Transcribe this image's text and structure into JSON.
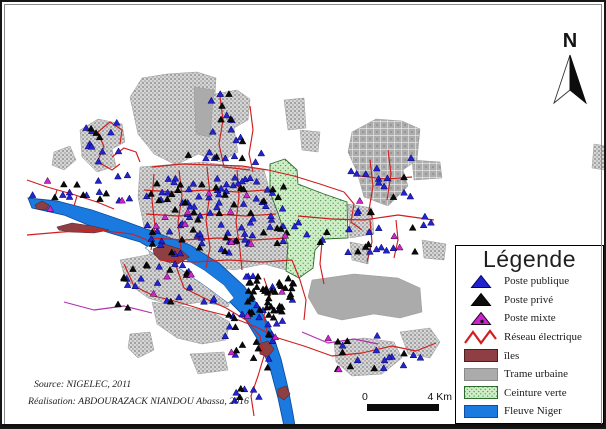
{
  "north": {
    "label": "N"
  },
  "legend": {
    "title": "Légende",
    "items": [
      {
        "label": "Poste publique",
        "swatch": "triangle",
        "color": "#2222cc",
        "edge": "#00006b"
      },
      {
        "label": "Poste privé",
        "swatch": "triangle",
        "color": "#0c0c0c",
        "edge": "#000000"
      },
      {
        "label": "Poste mixte",
        "swatch": "triangle-dot",
        "color": "#cc22cc",
        "edge": "#1a001a"
      },
      {
        "label": "Réseau électrique",
        "swatch": "zigzag",
        "color": "#cf1f1f",
        "edge": "#cf1f1f"
      },
      {
        "label": "îles",
        "swatch": "rect",
        "color": "#8e3f44",
        "edge": "#4a2021"
      },
      {
        "label": "Trame urbaine",
        "swatch": "rect",
        "color": "#ababab",
        "edge": "#8a8a8a"
      },
      {
        "label": "Ceinture verte",
        "swatch": "rect-dots",
        "color": "#cfeec8",
        "edge": "#2e6b2e"
      },
      {
        "label": "Fleuve Niger",
        "swatch": "rect",
        "color": "#1b7ae0",
        "edge": "#0f4f9e"
      }
    ]
  },
  "scale_bar": {
    "left_label": "0",
    "right_label": "4 Km"
  },
  "credits": {
    "line1": "Source: NIGELEC, 2011",
    "line2": "Réalisation: ABDOURAZACK NIANDOU Abassa, 2016"
  },
  "colors": {
    "river_fill": "#1b7ae0",
    "river_edge": "#0f4f9e",
    "island_fill": "#8e3f44",
    "island_edge": "#59272b",
    "urban_solid": "#ababab",
    "urban_edge": "#9a9a9a",
    "green_edge": "#2e6b2e",
    "network_red": "#cf1f1f",
    "network_magenta": "#b12fb1",
    "post_publique": "#2424cf",
    "post_publique_edge": "#000066",
    "post_prive": "#0a0a0a",
    "post_mixte": "#cf24cf",
    "post_mixte_edge": "#330033"
  },
  "geometry": {
    "urban_patches": [
      {
        "tex": "fine",
        "pts": "128,95 140,76 165,72 195,70 214,76 213,92 235,88 248,97 246,118 232,126 236,150 218,160 196,152 174,163 152,152 136,132"
      },
      {
        "tex": "solid",
        "pts": "192,85 212,88 208,135 194,132"
      },
      {
        "tex": "fine",
        "pts": "78,128 96,117 120,122 123,140 110,147 114,164 95,170 80,155"
      },
      {
        "tex": "fine",
        "pts": "52,150 68,144 74,158 62,168 50,163"
      },
      {
        "tex": "grid",
        "pts": "350,130 374,117 400,119 418,127 415,158 401,168 406,184 386,204 362,195 355,170 346,150"
      },
      {
        "tex": "grid",
        "pts": "410,158 438,160 440,176 412,178"
      },
      {
        "tex": "fine",
        "pts": "138,165 200,160 262,168 268,190 277,214 286,243 284,268 262,262 232,268 198,262 168,268 148,255 142,225 136,195"
      },
      {
        "tex": "fine",
        "pts": "346,202 370,206 372,232 348,236"
      },
      {
        "tex": "fine",
        "pts": "348,240 368,244 366,262 350,258"
      },
      {
        "tex": "solid",
        "pts": "310,278 352,272 396,276 418,286 420,310 398,316 372,312 340,318 316,312 306,295"
      },
      {
        "tex": "fine",
        "pts": "118,258 150,252 185,262 215,276 232,290 226,305 200,300 172,304 146,296 124,280"
      },
      {
        "tex": "fine",
        "pts": "150,300 180,304 210,310 228,320 224,338 200,342 175,336 155,322"
      },
      {
        "tex": "fine",
        "pts": "128,332 148,330 152,348 136,356 126,346"
      },
      {
        "tex": "fine",
        "pts": "188,352 222,350 226,368 196,372"
      },
      {
        "tex": "fine",
        "pts": "332,340 362,336 392,340 400,356 380,372 350,374 334,360"
      },
      {
        "tex": "fine",
        "pts": "398,330 428,326 438,340 428,356 406,352"
      },
      {
        "tex": "fine",
        "pts": "420,238 444,242 442,258 422,256"
      },
      {
        "tex": "fine",
        "pts": "282,98 302,96 304,126 286,128"
      },
      {
        "tex": "fine",
        "pts": "298,128 318,130 316,150 300,148"
      },
      {
        "tex": "fine",
        "pts": "592,142 604,144 603,168 590,166"
      }
    ],
    "green_belt": "268,162 283,157 295,168 296,182 322,192 345,200 346,236 323,237 313,248 311,266 297,276 284,269 286,243 277,214 268,190",
    "river": "26,196 55,199 90,208 125,220 155,231 188,243 218,262 242,284 258,306 270,330 279,357 286,386 291,412 293,424 282,424 276,396 268,366 256,338 240,312 220,292 196,274 168,258 138,240 98,228 62,213 30,206",
    "river_island": "150,242 178,254 202,268 222,283 232,296 226,301 206,286 180,268 152,252 143,246",
    "islands": [
      "33,203 40,199 47,203 44,208 35,207",
      "55,225 70,221 90,224 107,228 92,231 68,230 57,228",
      "151,247 162,242 178,247 187,255 176,262 158,258 152,252",
      "257,342 266,339 272,347 266,355 258,352",
      "276,387 284,384 288,392 282,398 276,394"
    ],
    "network": [
      {
        "c": "r",
        "pts": "25,233 60,230 95,228 130,232 150,240"
      },
      {
        "c": "r",
        "pts": "25,178 45,185 70,192 95,200 112,207"
      },
      {
        "c": "r",
        "pts": "55,188 52,198"
      },
      {
        "c": "r",
        "pts": "75,194 72,204"
      },
      {
        "c": "r",
        "pts": "95,160 102,145 96,130 108,120"
      },
      {
        "c": "r",
        "pts": "108,120 120,128 118,142"
      },
      {
        "c": "r",
        "pts": "96,160 110,168 118,162"
      },
      {
        "c": "r",
        "pts": "110,155 122,146 134,150 138,160"
      },
      {
        "c": "r",
        "pts": "150,165 180,162 210,163 240,164 266,168"
      },
      {
        "c": "r",
        "pts": "266,168 292,174 318,182 342,190"
      },
      {
        "c": "r",
        "pts": "218,95 221,118 217,142 222,165"
      },
      {
        "c": "r",
        "pts": "248,104 251,128 247,152 251,170"
      },
      {
        "c": "r",
        "pts": "222,165 248,168"
      },
      {
        "c": "r",
        "pts": "152,172 150,198 153,224 149,248"
      },
      {
        "c": "r",
        "pts": "177,168 180,194 176,220 179,246 174,264"
      },
      {
        "c": "r",
        "pts": "205,165 208,192 204,218 208,246 204,266"
      },
      {
        "c": "r",
        "pts": "235,168 237,194 234,220 238,248 240,268"
      },
      {
        "c": "r",
        "pts": "142,188 172,190 204,188 236,190 264,188"
      },
      {
        "c": "r",
        "pts": "144,212 176,214 210,212 244,214 274,212"
      },
      {
        "c": "r",
        "pts": "148,236 182,238 216,236 252,238 284,236"
      },
      {
        "c": "r",
        "pts": "158,258 192,260 226,258 260,260 290,258"
      },
      {
        "c": "r",
        "pts": "342,190 352,202 349,220 360,228"
      },
      {
        "c": "r",
        "pts": "296,214 330,217 362,218 396,213 432,218"
      },
      {
        "c": "r",
        "pts": "368,158 371,184 367,208 371,217"
      },
      {
        "c": "r",
        "pts": "386,148 389,172 385,198"
      },
      {
        "c": "r",
        "pts": "358,174 384,177 410,175"
      },
      {
        "c": "r",
        "pts": "368,218 370,240 365,260"
      },
      {
        "c": "r",
        "pts": "394,218 396,238 392,256"
      },
      {
        "c": "r",
        "pts": "174,264 182,286 202,296 224,306 244,318 258,334 262,354 256,374 249,394 252,414"
      },
      {
        "c": "r",
        "pts": "122,262 132,284 152,294 176,300 202,308 226,314"
      },
      {
        "c": "r",
        "pts": "226,314 252,324 276,336 302,344 330,354 360,351 390,344 414,349 434,341"
      },
      {
        "c": "m",
        "pts": "62,300 92,308 122,304 150,311"
      },
      {
        "c": "m",
        "pts": "300,330 326,341 352,337 376,342"
      },
      {
        "c": "r",
        "pts": "262,276 268,294 262,314 266,334"
      },
      {
        "c": "r",
        "pts": "290,258 298,278 304,298 302,318"
      },
      {
        "c": "r",
        "pts": "320,240 318,262 322,282"
      }
    ],
    "post_clusters": [
      {
        "cx": 60,
        "cy": 192,
        "rx": 35,
        "ry": 16,
        "pub": 5,
        "priv": 4,
        "mix": 2,
        "seed": 11
      },
      {
        "cx": 103,
        "cy": 142,
        "rx": 24,
        "ry": 22,
        "pub": 10,
        "priv": 3,
        "mix": 0,
        "seed": 22
      },
      {
        "cx": 228,
        "cy": 148,
        "rx": 44,
        "ry": 13,
        "pub": 9,
        "priv": 4,
        "mix": 0,
        "seed": 33
      },
      {
        "cx": 186,
        "cy": 214,
        "rx": 44,
        "ry": 38,
        "pub": 44,
        "priv": 22,
        "mix": 5,
        "seed": 44
      },
      {
        "cx": 254,
        "cy": 208,
        "rx": 34,
        "ry": 34,
        "pub": 28,
        "priv": 12,
        "mix": 4,
        "seed": 55
      },
      {
        "cx": 268,
        "cy": 294,
        "rx": 24,
        "ry": 20,
        "pub": 8,
        "priv": 40,
        "mix": 2,
        "seed": 66
      },
      {
        "cx": 220,
        "cy": 114,
        "rx": 12,
        "ry": 24,
        "pub": 6,
        "priv": 4,
        "mix": 0,
        "seed": 77
      },
      {
        "cx": 384,
        "cy": 184,
        "rx": 36,
        "ry": 28,
        "pub": 13,
        "priv": 4,
        "mix": 1,
        "seed": 88
      },
      {
        "cx": 388,
        "cy": 240,
        "rx": 42,
        "ry": 16,
        "pub": 9,
        "priv": 4,
        "mix": 2,
        "seed": 99
      },
      {
        "cx": 164,
        "cy": 284,
        "rx": 48,
        "ry": 24,
        "pub": 16,
        "priv": 11,
        "mix": 3,
        "seed": 111
      },
      {
        "cx": 254,
        "cy": 338,
        "rx": 32,
        "ry": 28,
        "pub": 13,
        "priv": 11,
        "mix": 2,
        "seed": 122
      },
      {
        "cx": 374,
        "cy": 351,
        "rx": 52,
        "ry": 18,
        "pub": 11,
        "priv": 7,
        "mix": 2,
        "seed": 133
      },
      {
        "cx": 245,
        "cy": 398,
        "rx": 14,
        "ry": 16,
        "pub": 5,
        "priv": 2,
        "mix": 0,
        "seed": 144
      },
      {
        "cx": 300,
        "cy": 231,
        "rx": 28,
        "ry": 11,
        "pub": 6,
        "priv": 5,
        "mix": 1,
        "seed": 155
      },
      {
        "cx": 116,
        "cy": 186,
        "rx": 20,
        "ry": 14,
        "pub": 6,
        "priv": 2,
        "mix": 1,
        "seed": 166
      },
      {
        "cx": 420,
        "cy": 220,
        "rx": 14,
        "ry": 8,
        "pub": 3,
        "priv": 1,
        "mix": 0,
        "seed": 177
      }
    ]
  }
}
